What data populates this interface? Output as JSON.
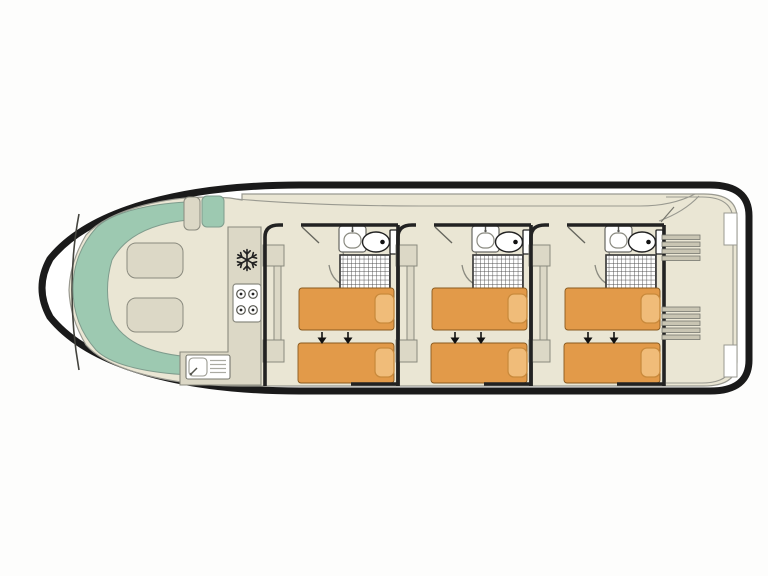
{
  "diagram": {
    "kind": "houseboat-deck-plan-top-view",
    "areas": {
      "bow_lounge": {
        "sofa": "u-shaped-sofa",
        "cushion_count": 2,
        "helm_seat_count": 2
      },
      "galley": {
        "appliances": [
          "fridge-freezer",
          "four-burner-hob",
          "sink-with-drainer"
        ]
      },
      "cabins": {
        "count": 3,
        "per_cabin": {
          "single_beds": 2,
          "pillows": 2,
          "bed_join_arrows": 2,
          "wardrobe_sections": 3,
          "ensuite_fixtures": [
            "washbasin",
            "toilet",
            "shower"
          ]
        }
      },
      "aft_deck": {
        "step_ladders": 2,
        "steps_per_ladder_top": 4,
        "steps_per_ladder_bottom": 5
      }
    }
  },
  "colors": {
    "hull": "#1a1a1a",
    "wall": "#222222",
    "floor": "#eae6d4",
    "furniture": "#dcd8c6",
    "sofa": "#9dc9b1",
    "bed": "#e29a49",
    "pillow": "#f0bc79",
    "fixture": "#ffffff",
    "steps": "#c9c5b3",
    "line": "#999999"
  }
}
